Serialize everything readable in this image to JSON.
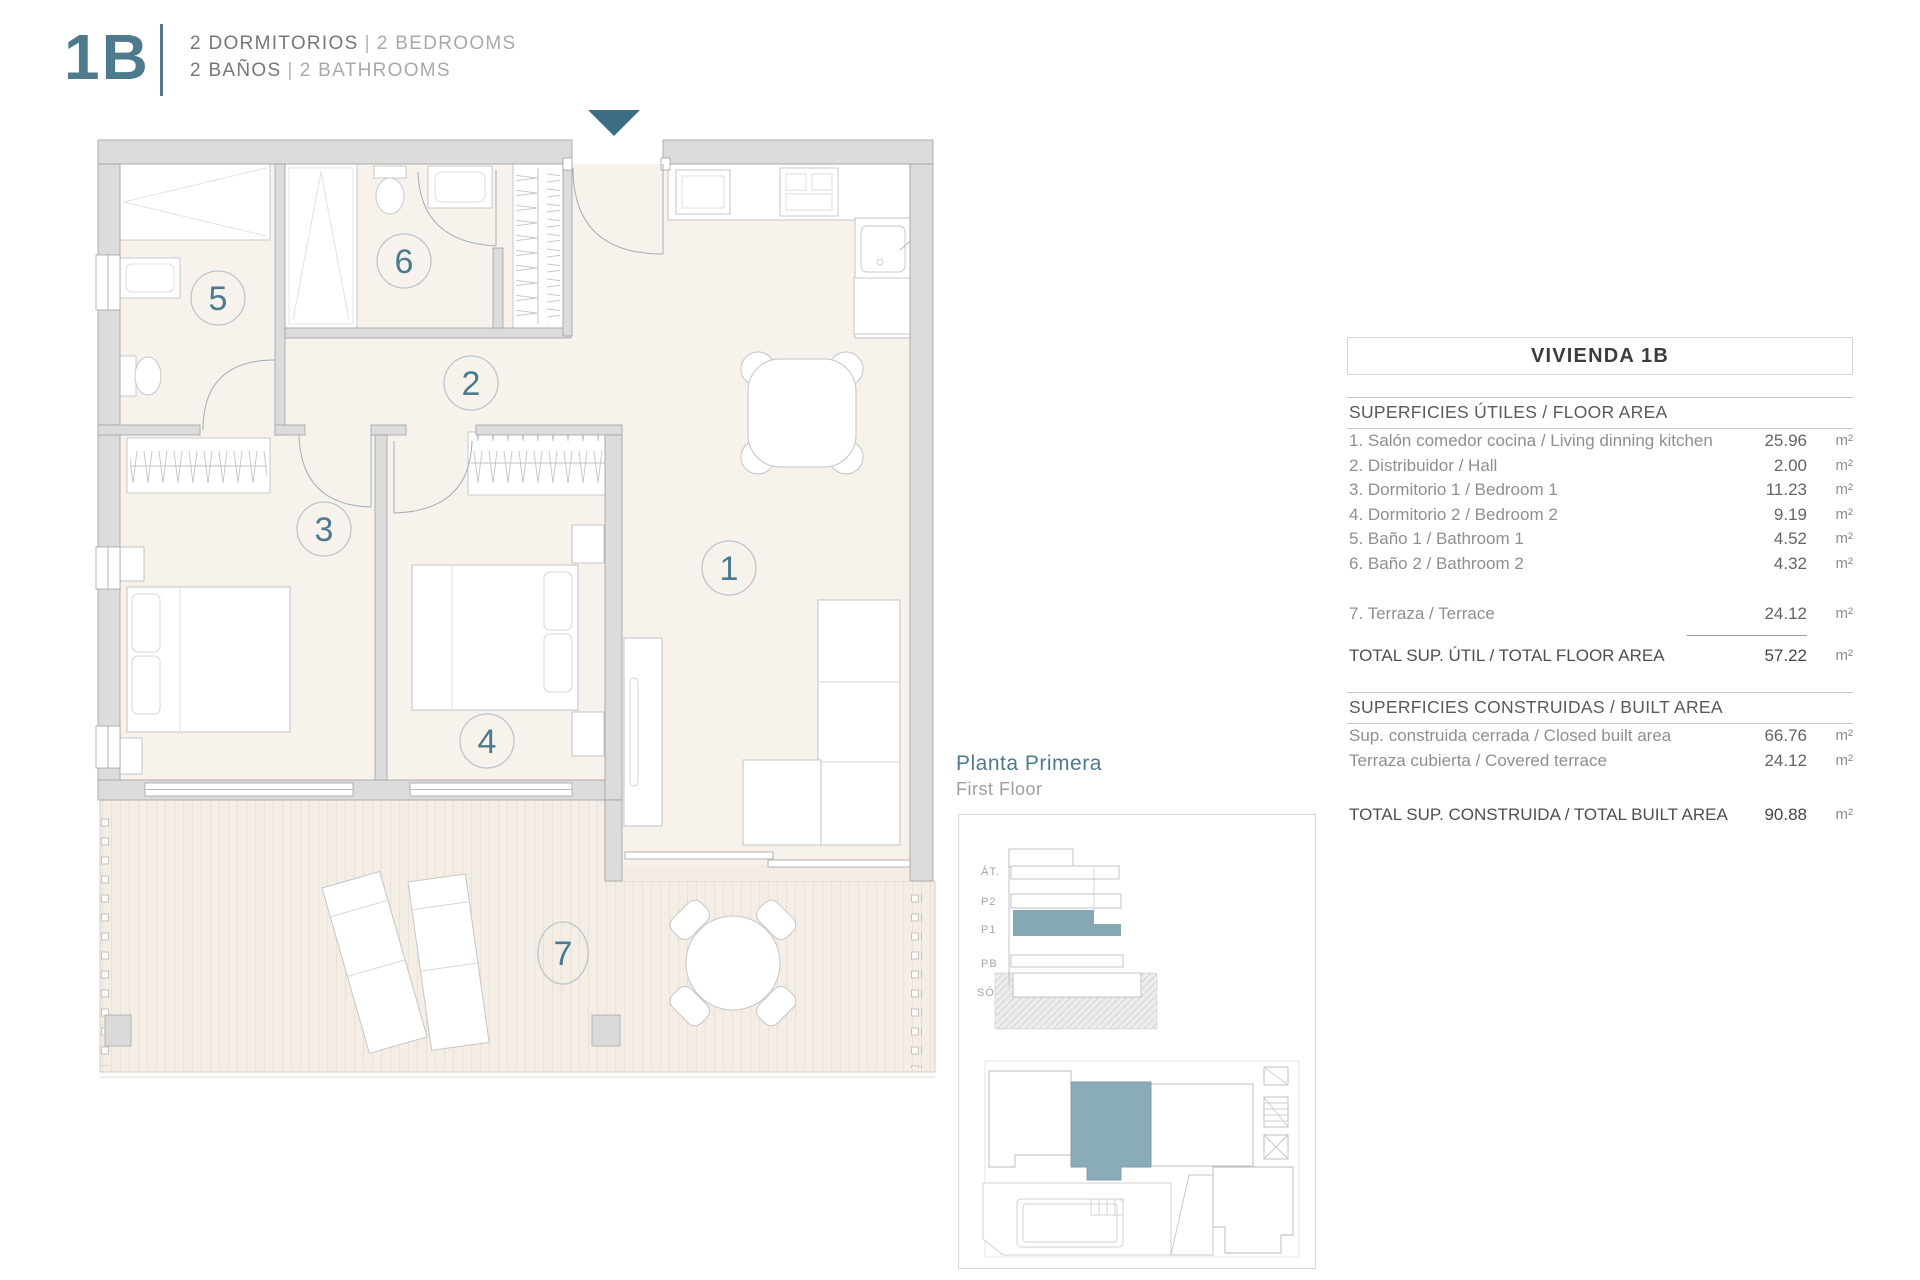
{
  "colors": {
    "accent": "#4e7a8e",
    "highlight": "#86a7b4"
  },
  "header": {
    "unit": "1B",
    "bedrooms_es": "2 DORMITORIOS",
    "bedrooms_en": "2 BEDROOMS",
    "bathrooms_es": "2 BAÑOS",
    "bathrooms_en": "2 BATHROOMS",
    "separator": "|"
  },
  "plan": {
    "room_numbers": [
      "1",
      "2",
      "3",
      "4",
      "5",
      "6",
      "7"
    ]
  },
  "floor_label": {
    "es": "Planta Primera",
    "en": "First Floor"
  },
  "stack": {
    "floors": [
      "ÁT.",
      "P2",
      "P1",
      "PB",
      "SÓT."
    ]
  },
  "table": {
    "title": "VIVIENDA 1B",
    "floor_area_header": "SUPERFICIES ÚTILES / FLOOR AREA",
    "floor_rows": [
      {
        "label": "1. Salón comedor cocina / Living dinning kitchen",
        "value": "25.96",
        "unit": "m²"
      },
      {
        "label": "2. Distribuidor / Hall",
        "value": "2.00",
        "unit": "m²"
      },
      {
        "label": "3. Dormitorio 1 / Bedroom 1",
        "value": "11.23",
        "unit": "m²"
      },
      {
        "label": "4. Dormitorio 2 / Bedroom 2",
        "value": "9.19",
        "unit": "m²"
      },
      {
        "label": "5. Baño 1 / Bathroom 1",
        "value": "4.52",
        "unit": "m²"
      },
      {
        "label": "6. Baño 2 / Bathroom 2",
        "value": "4.32",
        "unit": "m²"
      }
    ],
    "terrace_row": {
      "label": "7. Terraza / Terrace",
      "value": "24.12",
      "unit": "m²"
    },
    "total_floor": {
      "label": "TOTAL SUP. ÚTIL / TOTAL FLOOR AREA",
      "value": "57.22",
      "unit": "m²"
    },
    "built_area_header": "SUPERFICIES CONSTRUIDAS / BUILT AREA",
    "built_rows": [
      {
        "label": "Sup. construida cerrada / Closed built area",
        "value": "66.76",
        "unit": "m²"
      },
      {
        "label": "Terraza cubierta / Covered terrace",
        "value": "24.12",
        "unit": "m²"
      }
    ],
    "total_built": {
      "label": "TOTAL SUP. CONSTRUIDA /  TOTAL BUILT AREA",
      "value": "90.88",
      "unit": "m²"
    }
  }
}
